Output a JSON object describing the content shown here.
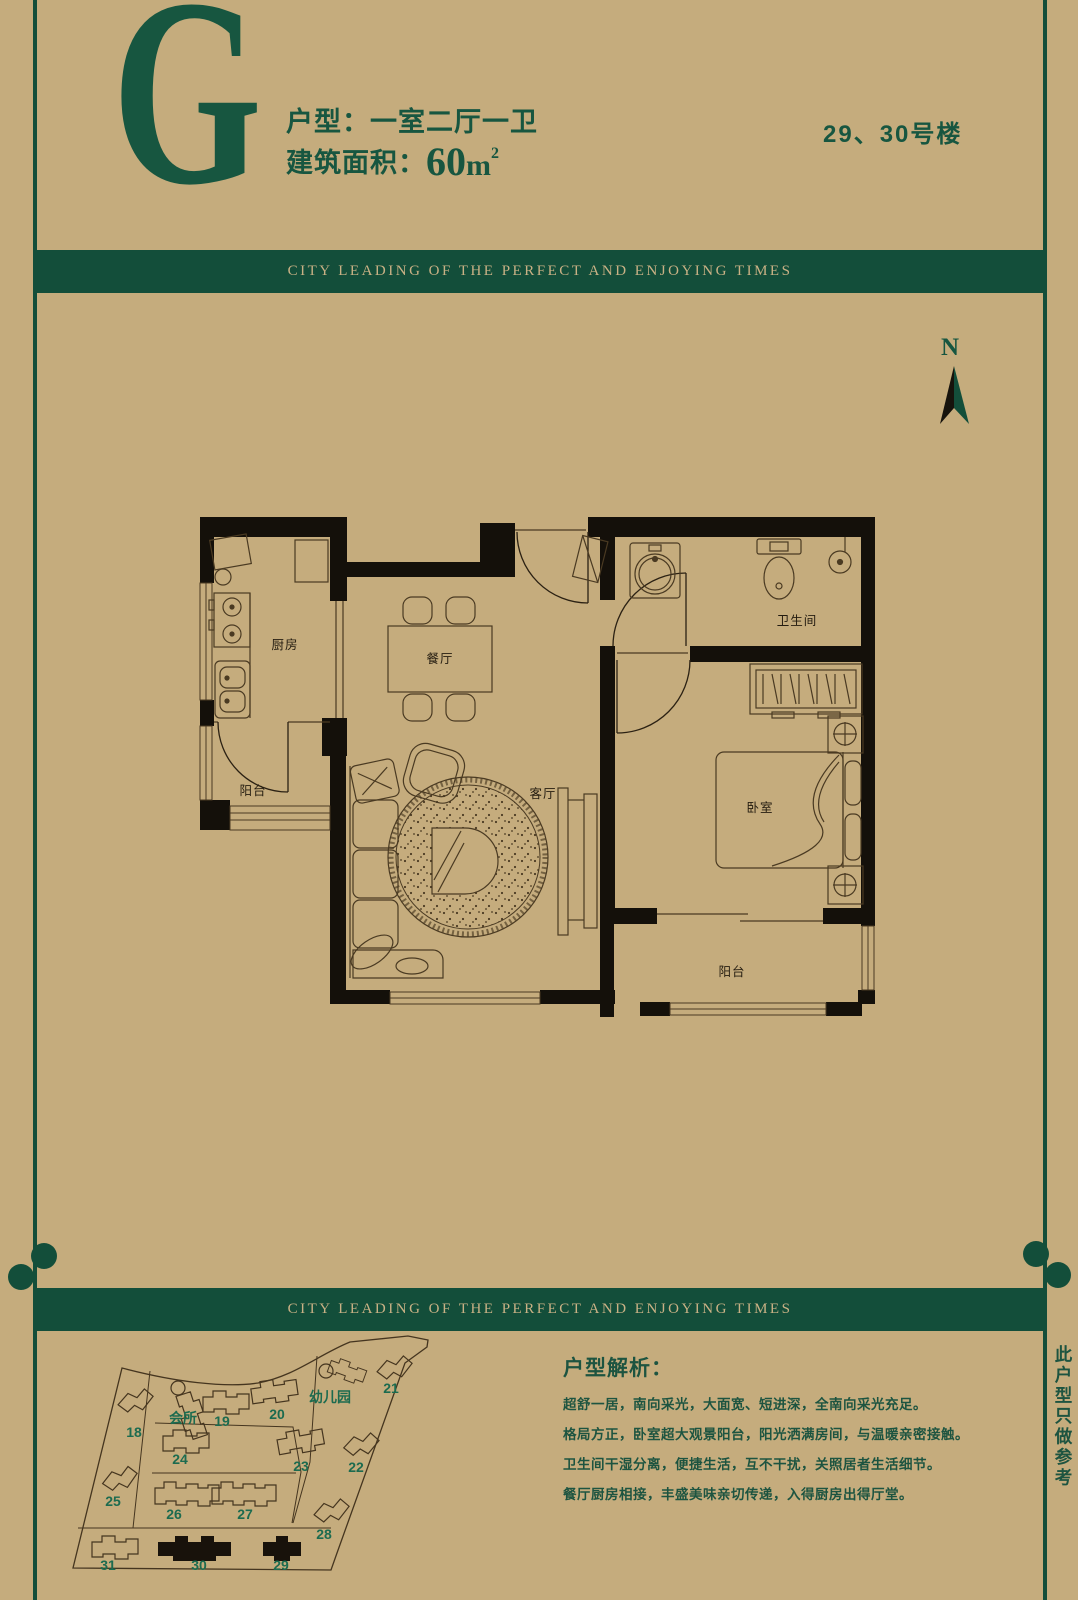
{
  "header": {
    "letter": "G",
    "type_line": "户型：一室二厅一卫",
    "area_label": "建筑面积：",
    "area_number": "60",
    "area_unit": "m",
    "area_sup": "2",
    "buildings_tag": "29、30号楼"
  },
  "banner": {
    "text": "CITY LEADING OF THE PERFECT AND ENJOYING TIMES"
  },
  "compass": {
    "label": "N"
  },
  "plan": {
    "rooms": {
      "kitchen": "厨房",
      "dining": "餐厅",
      "balcony_left": "阳台",
      "living": "客厅",
      "bathroom": "卫生间",
      "bedroom": "卧室",
      "balcony_bottom": "阳台"
    }
  },
  "sitemap": {
    "clubhouse": "会所",
    "kindergarten": "幼儿园",
    "numbers": [
      "18",
      "19",
      "20",
      "21",
      "22",
      "23",
      "24",
      "25",
      "26",
      "27",
      "28",
      "29",
      "30",
      "31"
    ]
  },
  "analysis": {
    "title": "户型解析：",
    "lines": [
      "超舒一居，南向采光，大面宽、短进深，全南向采光充足。",
      "格局方正，卧室超大观景阳台，阳光洒满房间，与温暖亲密接触。",
      "卫生间干湿分离，便捷生活，互不干扰，关照居者生活细节。",
      "餐厅厨房相接，丰盛美味亲切传递，入得厨房出得厅堂。"
    ]
  },
  "side_note": {
    "text": "此户型只做参考"
  },
  "colors": {
    "background": "#c5ac7d",
    "green": "#175640",
    "banner_bg": "#134e3a",
    "banner_text": "#c9b185"
  }
}
